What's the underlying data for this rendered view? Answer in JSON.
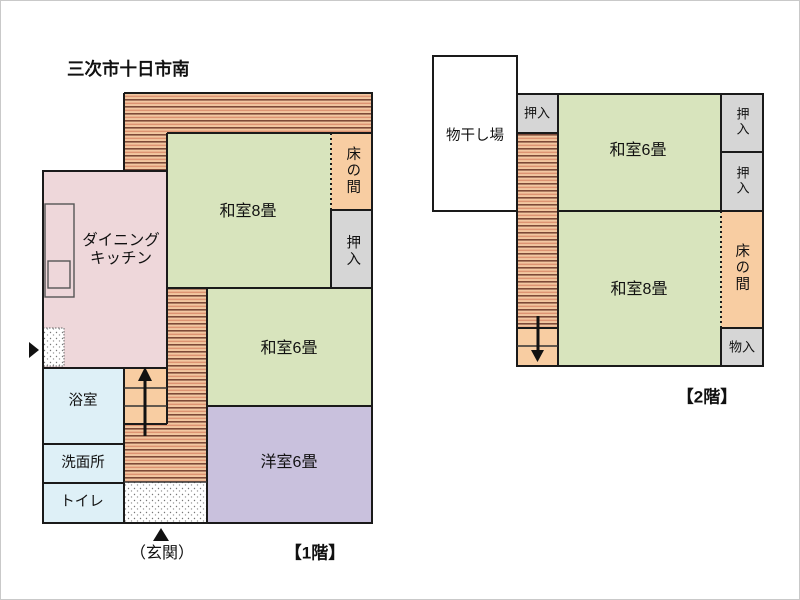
{
  "title": "三次市十日市南",
  "floor1": {
    "floor_label": "【1階】",
    "entrance_label": "（玄関）",
    "rooms": {
      "dining_line1": "ダイニング",
      "dining_line2": "キッチン",
      "washitsu8": "和室8畳",
      "washitsu6": "和室6畳",
      "youshitsu6": "洋室6畳",
      "tokonoma": "床の間",
      "oshiire": "押入",
      "bathroom": "浴室",
      "washroom": "洗面所",
      "toilet": "トイレ"
    }
  },
  "floor2": {
    "floor_label": "【2階】",
    "rooms": {
      "drying_area": "物干し場",
      "oshiire_top": "押入",
      "washitsu6": "和室6畳",
      "oshiire_right_upper": "押入",
      "oshiire_right_lower": "押入",
      "washitsu8": "和室8畳",
      "tokonoma": "床の間",
      "storage": "物入"
    }
  },
  "colors": {
    "tatami_green": "#d8e4bd",
    "kitchen_pink": "#eed7da",
    "western_purple": "#c9c1dd",
    "bath_blue": "#def0f7",
    "tokonoma_orange": "#f8cda2",
    "closet_gray": "#d6d6d6",
    "engawa_base": "#f2c7a1",
    "engawa_dark": "#7d4937",
    "engawa_mid": "#dd9372",
    "wall": "#1a1a1a"
  }
}
